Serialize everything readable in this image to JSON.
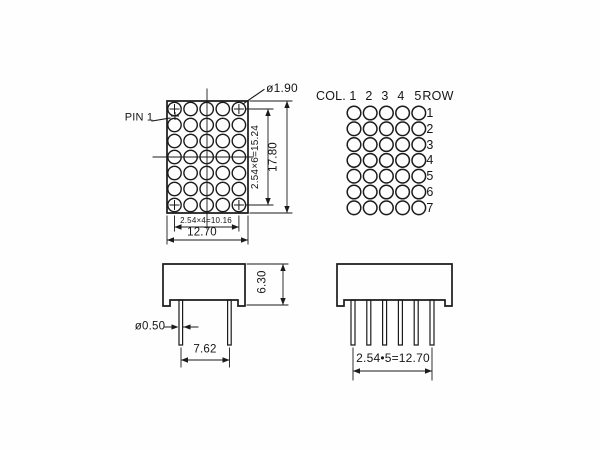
{
  "drawing": {
    "line_color": "#1b1b1b",
    "background": "#fefefe",
    "matrix_front": {
      "pin1_label": "PIN 1",
      "dot_diameter": "ø1.90",
      "row_pitch": "2.54×6=15.24",
      "overall_height": "17.80",
      "column_pitch": "2.54×4=10.16",
      "overall_width": "12.70",
      "grid": {
        "cols": 5,
        "rows": 7
      }
    },
    "pin_map": {
      "col_header": "COL.",
      "col_numbers": [
        "1",
        "2",
        "3",
        "4",
        "5"
      ],
      "row_header": "ROW",
      "row_numbers": [
        "1",
        "2",
        "3",
        "4",
        "5",
        "6",
        "7"
      ],
      "grid": {
        "cols": 5,
        "rows": 7
      }
    },
    "side_view": {
      "body_height": "6.30",
      "pin_diameter": "ø0.50",
      "pin_spacing": "7.62"
    },
    "front_view": {
      "pin_row_pitch": "2.54•5=12.70"
    }
  }
}
